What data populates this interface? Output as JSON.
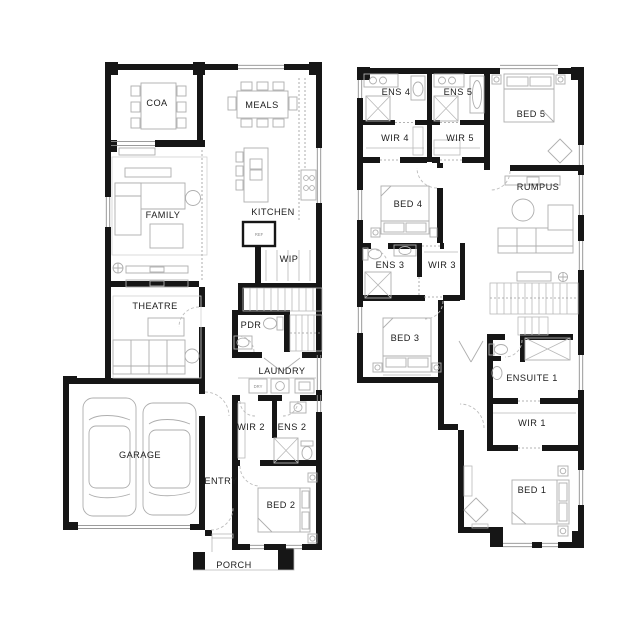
{
  "colors": {
    "background": "#ffffff",
    "wall": "#161616",
    "furniture_line": "#aeaeae",
    "label_text": "#202020"
  },
  "floors": {
    "ground": {
      "rooms": {
        "coa": "COA",
        "meals": "MEALS",
        "kitchen": "KITCHEN",
        "family": "FAMILY",
        "wip": "WIP",
        "theatre": "THEATRE",
        "pdr": "PDR",
        "laundry": "LAUNDRY",
        "wir2": "WIR 2",
        "ens2": "ENS 2",
        "garage": "GARAGE",
        "entry": "ENTRY",
        "bed2": "BED 2",
        "porch": "PORCH"
      },
      "fixtures": {
        "fridge": "REF",
        "dryer": "DRY"
      }
    },
    "first": {
      "rooms": {
        "ens4": "ENS 4",
        "ens5": "ENS 5",
        "bed5": "BED 5",
        "wir4": "WIR 4",
        "wir5": "WIR 5",
        "bed4": "BED 4",
        "rumpus": "RUMPUS",
        "ens3": "ENS 3",
        "wir3": "WIR 3",
        "bed3": "BED 3",
        "ensuite1": "ENSUITE 1",
        "wir1": "WIR 1",
        "bed1": "BED 1"
      }
    }
  }
}
